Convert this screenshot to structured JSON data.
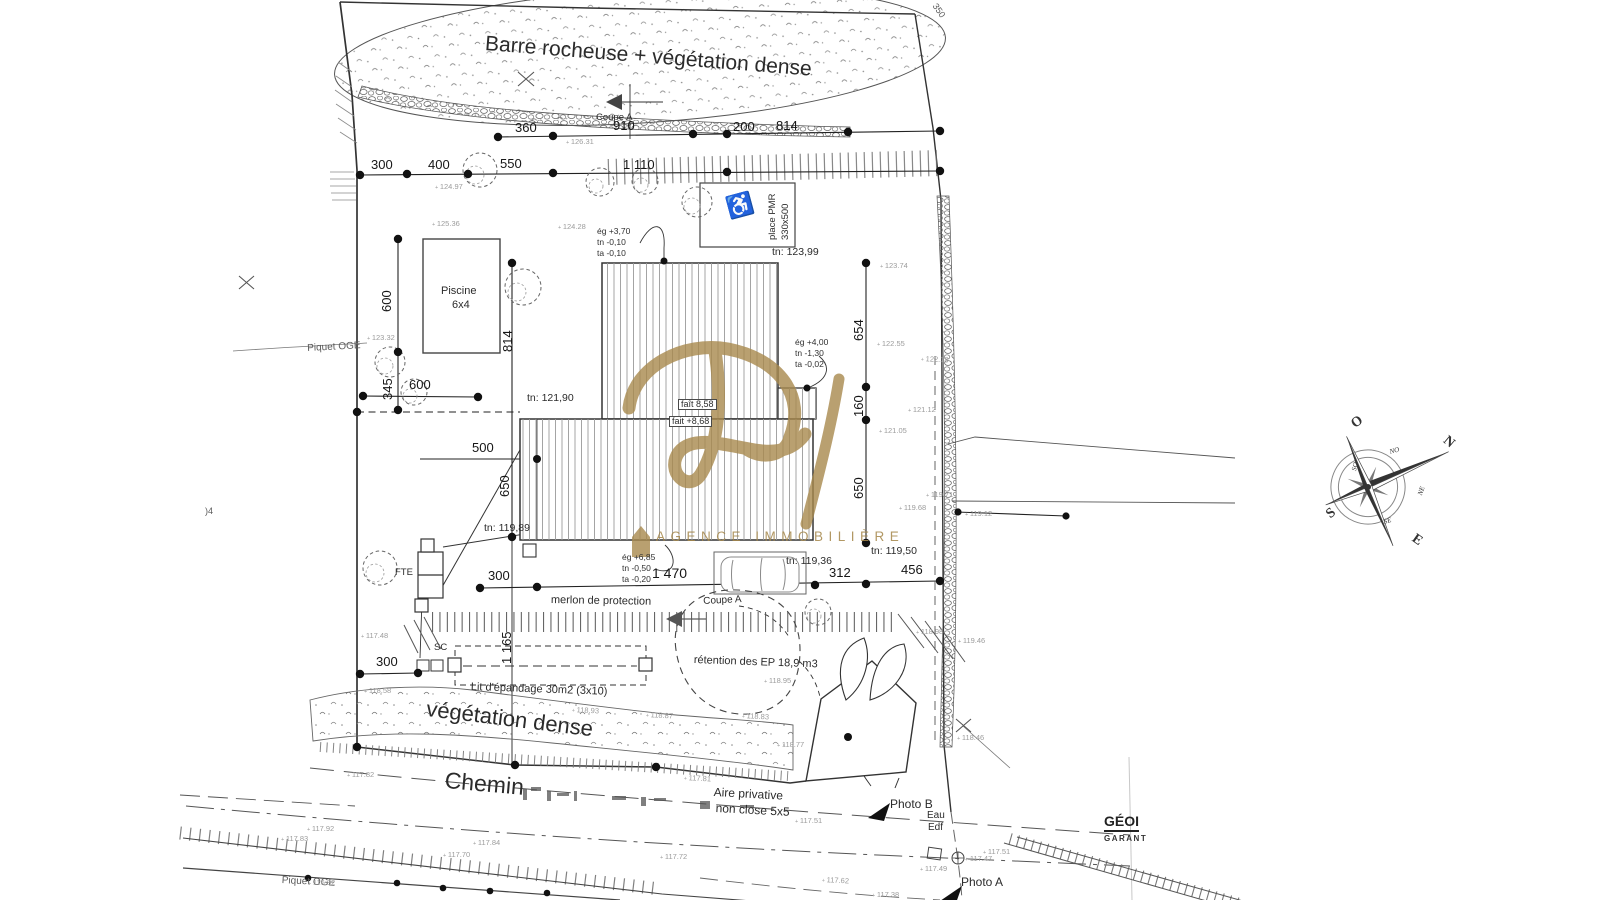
{
  "watermark": {
    "letter": "R",
    "agency": "AGENCE IMMOBILIÈRE",
    "color": "#a5874a"
  },
  "surveyor": {
    "name": "GÉOI",
    "sub": "GARANT"
  },
  "compass": {
    "cardinals": [
      "N",
      "S",
      "E",
      "O"
    ],
    "intercardinals": [
      "NO",
      "NE",
      "SE",
      "SO"
    ]
  },
  "labels": [
    {
      "n": "zone-barre-rocheuse",
      "t": "Barre rocheuse + végétation dense",
      "x": 486,
      "y": 33,
      "fs": 21,
      "r": 4.5
    },
    {
      "n": "zone-vegetation-dense",
      "t": "végétation dense",
      "x": 428,
      "y": 697,
      "fs": 22,
      "r": 7
    },
    {
      "n": "road-chemin",
      "t": "Chemin",
      "x": 446,
      "y": 768,
      "fs": 23,
      "r": 5
    },
    {
      "n": "aire-privative-line1",
      "t": "Aire privative",
      "x": 714,
      "y": 786,
      "fs": 12,
      "r": 3
    },
    {
      "n": "aire-privative-line2",
      "t": "non close 5x5",
      "x": 716,
      "y": 802,
      "fs": 12,
      "r": 3
    },
    {
      "n": "merlon-label",
      "t": "merlon de protection",
      "x": 551,
      "y": 595,
      "fs": 11,
      "r": 1
    },
    {
      "n": "lit-epandage-label",
      "t": "Lit d'épandage 30m2 (3x10)",
      "x": 471,
      "y": 682,
      "fs": 11,
      "r": 2
    },
    {
      "n": "retention-label",
      "t": "rétention des EP 18,9 m3",
      "x": 694,
      "y": 655,
      "fs": 11,
      "r": 2
    },
    {
      "n": "piscine-label",
      "t": "Piscine",
      "x": 441,
      "y": 286,
      "fs": 11
    },
    {
      "n": "piscine-dim",
      "t": "6x4",
      "x": 452,
      "y": 300,
      "fs": 11
    },
    {
      "n": "place-pmr-label",
      "t": "place PMR",
      "x": 768,
      "y": 240,
      "fs": 9.5,
      "r": -90
    },
    {
      "n": "place-pmr-dim",
      "t": "330x500",
      "x": 781,
      "y": 240,
      "fs": 9.5,
      "r": -90
    },
    {
      "n": "wheelchair-icon",
      "t": "♿",
      "x": 724,
      "y": 198,
      "fs": 22,
      "r": -15,
      "c": "mid"
    },
    {
      "n": "coupe-a-top",
      "t": "Coupe A",
      "x": 596,
      "y": 113,
      "fs": 9.5
    },
    {
      "n": "coupe-a-bottom",
      "t": "Coupe A",
      "x": 703,
      "y": 597,
      "fs": 10,
      "r": -3
    },
    {
      "n": "tn-123-99",
      "t": "tn: 123,99",
      "x": 772,
      "y": 247,
      "fs": 10.5
    },
    {
      "n": "tn-121-90",
      "t": "tn: 121,90",
      "x": 527,
      "y": 393,
      "fs": 10.5
    },
    {
      "n": "tn-119-89",
      "t": "tn: 119,89",
      "x": 484,
      "y": 523,
      "fs": 10.5
    },
    {
      "n": "tn-119-36",
      "t": "tn: 119,36",
      "x": 786,
      "y": 556,
      "fs": 10.5
    },
    {
      "n": "tn-119-50",
      "t": "tn: 119,50",
      "x": 871,
      "y": 546,
      "fs": 10.5
    },
    {
      "n": "cote-egout-1",
      "t": "ég +3,70\ntn -0,10\nta -0,10",
      "x": 597,
      "y": 226,
      "fs": 8.5,
      "c": "tri"
    },
    {
      "n": "cote-egout-2",
      "t": "ég +4,00\ntn -1,30\nta -0,02",
      "x": 795,
      "y": 337,
      "fs": 8.5,
      "c": "tri"
    },
    {
      "n": "cote-egout-3",
      "t": "ég +6,85\ntn -0,50\nta -0,20",
      "x": 622,
      "y": 552,
      "fs": 8.5,
      "c": "tri"
    },
    {
      "n": "faitage-1",
      "t": "faît 8,58",
      "x": 678,
      "y": 399,
      "fs": 9,
      "box": true
    },
    {
      "n": "faitage-2",
      "t": "fait +8,68",
      "x": 669,
      "y": 416,
      "fs": 9,
      "box": true
    },
    {
      "n": "dim-360",
      "t": "360",
      "x": 515,
      "y": 121,
      "fs": 13,
      "c": "dim"
    },
    {
      "n": "dim-910",
      "t": "910",
      "x": 613,
      "y": 119,
      "fs": 13,
      "c": "dim"
    },
    {
      "n": "dim-200",
      "t": "200",
      "x": 733,
      "y": 120,
      "fs": 13,
      "c": "dim"
    },
    {
      "n": "dim-814-top",
      "t": "814",
      "x": 776,
      "y": 119,
      "fs": 13,
      "c": "dim"
    },
    {
      "n": "dim-300-top",
      "t": "300",
      "x": 371,
      "y": 158,
      "fs": 13,
      "c": "dim"
    },
    {
      "n": "dim-400",
      "t": "400",
      "x": 428,
      "y": 158,
      "fs": 13,
      "c": "dim"
    },
    {
      "n": "dim-550",
      "t": "550",
      "x": 500,
      "y": 157,
      "fs": 13,
      "c": "dim"
    },
    {
      "n": "dim-1110",
      "t": "1 110",
      "x": 623,
      "y": 158,
      "fs": 13,
      "c": "dim"
    },
    {
      "n": "dim-600-v",
      "t": "600",
      "x": 380,
      "y": 312,
      "fs": 13,
      "r": -90,
      "c": "dim"
    },
    {
      "n": "dim-345-v",
      "t": "345",
      "x": 381,
      "y": 400,
      "fs": 13,
      "r": -90,
      "c": "dim"
    },
    {
      "n": "dim-600-h",
      "t": "600",
      "x": 409,
      "y": 378,
      "fs": 13,
      "c": "dim"
    },
    {
      "n": "dim-814-v",
      "t": "814",
      "x": 501,
      "y": 352,
      "fs": 13,
      "r": -90,
      "c": "dim"
    },
    {
      "n": "dim-500",
      "t": "500",
      "x": 472,
      "y": 441,
      "fs": 13,
      "c": "dim"
    },
    {
      "n": "dim-650-left",
      "t": "650",
      "x": 498,
      "y": 497,
      "fs": 13,
      "r": -90,
      "c": "dim"
    },
    {
      "n": "dim-654",
      "t": "654",
      "x": 852,
      "y": 341,
      "fs": 13,
      "r": -90,
      "c": "dim"
    },
    {
      "n": "dim-160",
      "t": "160",
      "x": 852,
      "y": 417,
      "fs": 13,
      "r": -90,
      "c": "dim"
    },
    {
      "n": "dim-650-right",
      "t": "650",
      "x": 852,
      "y": 499,
      "fs": 13,
      "r": -90,
      "c": "dim"
    },
    {
      "n": "dim-300-bottom",
      "t": "300",
      "x": 488,
      "y": 569,
      "fs": 13,
      "c": "dim"
    },
    {
      "n": "dim-1470",
      "t": "1 470",
      "x": 652,
      "y": 566,
      "fs": 14,
      "c": "dim"
    },
    {
      "n": "dim-312",
      "t": "312",
      "x": 829,
      "y": 566,
      "fs": 13,
      "c": "dim"
    },
    {
      "n": "dim-456",
      "t": "456",
      "x": 901,
      "y": 563,
      "fs": 13,
      "c": "dim"
    },
    {
      "n": "dim-300-low",
      "t": "300",
      "x": 376,
      "y": 655,
      "fs": 13,
      "c": "dim"
    },
    {
      "n": "dim-1165",
      "t": "1 165",
      "x": 500,
      "y": 664,
      "fs": 13,
      "r": -90,
      "c": "dim"
    },
    {
      "n": "piquet-oge-top",
      "t": "Piquet OGE",
      "x": 307,
      "y": 344,
      "fs": 10,
      "r": -3,
      "c": "mid"
    },
    {
      "n": "piquet-oge-bottom",
      "t": "Piquet OGE",
      "x": 282,
      "y": 876,
      "fs": 10,
      "r": 3,
      "c": "mid"
    },
    {
      "n": "fte-label",
      "t": "FTE",
      "x": 395,
      "y": 568,
      "fs": 9.5
    },
    {
      "n": "sc-label",
      "t": "SC",
      "x": 434,
      "y": 643,
      "fs": 9.5
    },
    {
      "n": "photo-b-label",
      "t": "Photo B",
      "x": 890,
      "y": 798,
      "fs": 12
    },
    {
      "n": "photo-a-label",
      "t": "Photo A",
      "x": 961,
      "y": 876,
      "fs": 12
    },
    {
      "n": "utility-eau",
      "t": "Eau",
      "x": 927,
      "y": 811,
      "fs": 10
    },
    {
      "n": "utility-edf",
      "t": "Edf",
      "x": 928,
      "y": 823,
      "fs": 10
    },
    {
      "n": "parcel-350",
      "t": "350",
      "x": 938,
      "y": 2,
      "fs": 9,
      "r": 55,
      "c": "mid"
    },
    {
      "n": "edge-mark",
      "t": ")4",
      "x": 205,
      "y": 507,
      "fs": 9,
      "c": "mid"
    },
    {
      "n": "compass-n",
      "t": "N",
      "x": 1449,
      "y": 434,
      "fs": 14,
      "r": 40,
      "b": true,
      "c": "compass"
    },
    {
      "n": "compass-o",
      "t": "O",
      "x": 1349,
      "y": 420,
      "fs": 14,
      "r": -35,
      "b": true,
      "c": "compass"
    },
    {
      "n": "compass-s",
      "t": "S",
      "x": 1324,
      "y": 511,
      "fs": 14,
      "r": -40,
      "b": true,
      "c": "compass"
    },
    {
      "n": "compass-e",
      "t": "E",
      "x": 1417,
      "y": 532,
      "fs": 14,
      "r": 35,
      "b": true,
      "c": "compass"
    },
    {
      "n": "compass-no",
      "t": "NO",
      "x": 1389,
      "y": 449,
      "fs": 7,
      "r": -15,
      "c": "compass ital"
    },
    {
      "n": "compass-so",
      "t": "SO",
      "x": 1351,
      "y": 470,
      "fs": 7,
      "r": -75,
      "c": "compass ital"
    },
    {
      "n": "compass-ne",
      "t": "NE",
      "x": 1417,
      "y": 494,
      "fs": 7,
      "r": -70,
      "c": "compass ital"
    },
    {
      "n": "compass-se",
      "t": "SE",
      "x": 1383,
      "y": 519,
      "fs": 7,
      "r": -15,
      "c": "compass ital"
    },
    {
      "n": "spot-elevation",
      "t": "126.31",
      "x": 566,
      "y": 138,
      "fs": 7.5,
      "c": "faint elev"
    },
    {
      "n": "spot-elevation",
      "t": "124.97",
      "x": 435,
      "y": 183,
      "fs": 7.5,
      "c": "faint elev"
    },
    {
      "n": "spot-elevation",
      "t": "125.36",
      "x": 432,
      "y": 220,
      "fs": 7.5,
      "c": "faint elev"
    },
    {
      "n": "spot-elevation",
      "t": "124.28",
      "x": 558,
      "y": 223,
      "fs": 7.5,
      "c": "faint elev"
    },
    {
      "n": "spot-elevation",
      "t": "123.74",
      "x": 880,
      "y": 262,
      "fs": 7.5,
      "c": "faint elev"
    },
    {
      "n": "spot-elevation",
      "t": "123.32",
      "x": 367,
      "y": 334,
      "fs": 7.5,
      "c": "faint elev"
    },
    {
      "n": "spot-elevation",
      "t": "122.55",
      "x": 877,
      "y": 340,
      "fs": 7.5,
      "c": "faint elev"
    },
    {
      "n": "spot-elevation",
      "t": "122.18",
      "x": 921,
      "y": 355,
      "fs": 7.5,
      "r": 3,
      "c": "faint elev"
    },
    {
      "n": "spot-elevation",
      "t": "121.12",
      "x": 908,
      "y": 406,
      "fs": 7.5,
      "c": "faint elev"
    },
    {
      "n": "spot-elevation",
      "t": "121.05",
      "x": 879,
      "y": 427,
      "fs": 7.5,
      "c": "faint elev"
    },
    {
      "n": "spot-elevation",
      "t": "119.71",
      "x": 926,
      "y": 491,
      "fs": 7.5,
      "c": "faint elev"
    },
    {
      "n": "spot-elevation",
      "t": "119.68",
      "x": 899,
      "y": 504,
      "fs": 7.5,
      "c": "faint elev"
    },
    {
      "n": "spot-elevation",
      "t": "119.12",
      "x": 965,
      "y": 510,
      "fs": 7.5,
      "c": "faint elev"
    },
    {
      "n": "spot-elevation",
      "t": "118.98",
      "x": 916,
      "y": 628,
      "fs": 7.5,
      "c": "faint elev"
    },
    {
      "n": "spot-elevation",
      "t": "119.46",
      "x": 958,
      "y": 637,
      "fs": 7.5,
      "c": "faint elev"
    },
    {
      "n": "spot-elevation",
      "t": "118.46",
      "x": 957,
      "y": 734,
      "fs": 7.5,
      "c": "faint elev"
    },
    {
      "n": "spot-elevation",
      "t": "118.95",
      "x": 764,
      "y": 677,
      "fs": 7.5,
      "c": "faint elev"
    },
    {
      "n": "spot-elevation",
      "t": "118.93",
      "x": 572,
      "y": 706,
      "fs": 7.5,
      "r": 3,
      "c": "faint elev"
    },
    {
      "n": "spot-elevation",
      "t": "118.87",
      "x": 646,
      "y": 711,
      "fs": 7.5,
      "r": 3,
      "c": "faint elev"
    },
    {
      "n": "spot-elevation",
      "t": "118.83",
      "x": 742,
      "y": 712,
      "fs": 7.5,
      "r": 3,
      "c": "faint elev"
    },
    {
      "n": "spot-elevation",
      "t": "118.77",
      "x": 777,
      "y": 741,
      "fs": 7.5,
      "c": "faint elev"
    },
    {
      "n": "spot-elevation",
      "t": "118.58",
      "x": 364,
      "y": 687,
      "fs": 7.5,
      "c": "faint elev"
    },
    {
      "n": "spot-elevation",
      "t": "117.48",
      "x": 361,
      "y": 632,
      "fs": 7.5,
      "c": "faint elev"
    },
    {
      "n": "spot-elevation",
      "t": "117.82",
      "x": 347,
      "y": 771,
      "fs": 7.5,
      "c": "faint elev"
    },
    {
      "n": "spot-elevation",
      "t": "117.81",
      "x": 684,
      "y": 774,
      "fs": 7.5,
      "r": 3,
      "c": "faint elev"
    },
    {
      "n": "spot-elevation",
      "t": "117.92",
      "x": 307,
      "y": 825,
      "fs": 7.5,
      "c": "faint elev"
    },
    {
      "n": "spot-elevation",
      "t": "117.83",
      "x": 281,
      "y": 835,
      "fs": 7.5,
      "c": "faint elev"
    },
    {
      "n": "spot-elevation",
      "t": "117.84",
      "x": 473,
      "y": 839,
      "fs": 7.5,
      "c": "faint elev"
    },
    {
      "n": "spot-elevation",
      "t": "117.70",
      "x": 443,
      "y": 851,
      "fs": 7.5,
      "c": "faint elev"
    },
    {
      "n": "spot-elevation",
      "t": "116.82",
      "x": 308,
      "y": 879,
      "fs": 7.5,
      "c": "faint elev"
    },
    {
      "n": "spot-elevation",
      "t": "117.72",
      "x": 660,
      "y": 853,
      "fs": 7.5,
      "c": "faint elev"
    },
    {
      "n": "spot-elevation",
      "t": "117.62",
      "x": 822,
      "y": 876,
      "fs": 7.5,
      "r": 3,
      "c": "faint elev"
    },
    {
      "n": "spot-elevation",
      "t": "117.51",
      "x": 795,
      "y": 817,
      "fs": 7.5,
      "c": "faint elev"
    },
    {
      "n": "spot-elevation",
      "t": "117.51",
      "x": 983,
      "y": 848,
      "fs": 7.5,
      "c": "faint elev"
    },
    {
      "n": "spot-elevation",
      "t": "117.49",
      "x": 920,
      "y": 865,
      "fs": 7.5,
      "c": "faint elev"
    },
    {
      "n": "spot-elevation",
      "t": "117.47",
      "x": 965,
      "y": 855,
      "fs": 7.5,
      "c": "faint elev"
    },
    {
      "n": "spot-elevation",
      "t": "117.38",
      "x": 872,
      "y": 891,
      "fs": 7.5,
      "c": "faint elev"
    }
  ]
}
